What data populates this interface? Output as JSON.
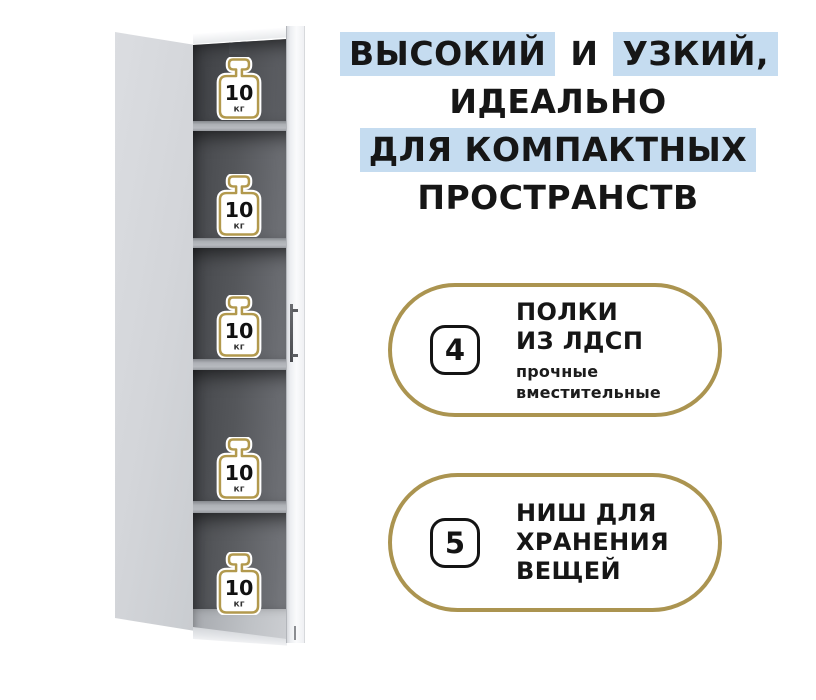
{
  "colors": {
    "highlight": "#c5dcf0",
    "gold": "#ab9450",
    "ink": "#161616"
  },
  "headline": {
    "segment1": "ВЫСОКИЙ",
    "segment2": "И",
    "segment3": "УЗКИЙ,",
    "line2": "ИДЕАЛЬНО",
    "line3": "ДЛЯ КОМПАКТНЫХ",
    "line4": "ПРОСТРАНСТВ"
  },
  "cabinet": {
    "compartment_count": 5,
    "weight": {
      "value": "10",
      "unit": "кг"
    }
  },
  "features": [
    {
      "number": "4",
      "title_lines": [
        "ПОЛКИ",
        "ИЗ ЛДСП"
      ],
      "subtitle_lines": [
        "прочные",
        "вместительные"
      ]
    },
    {
      "number": "5",
      "title_lines": [
        "НИШ ДЛЯ",
        "ХРАНЕНИЯ",
        "ВЕЩЕЙ"
      ],
      "subtitle_lines": []
    }
  ]
}
